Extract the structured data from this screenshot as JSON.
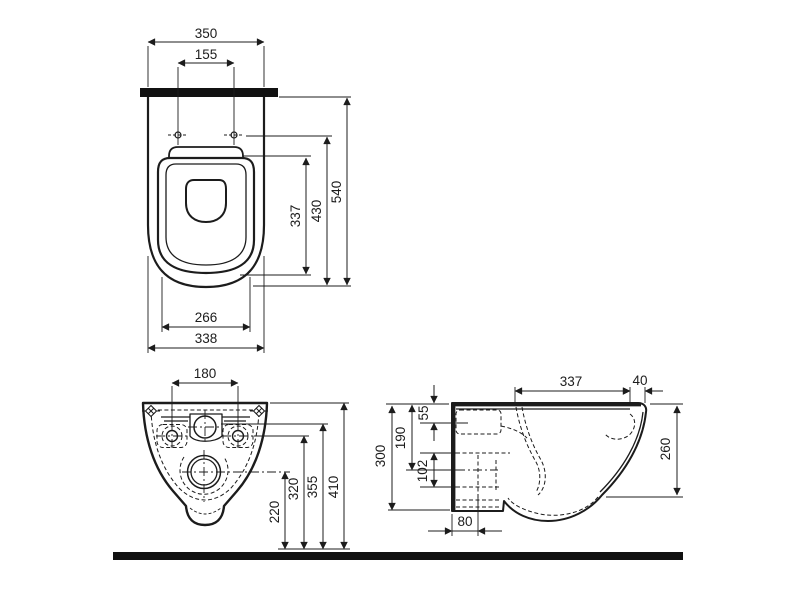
{
  "page": {
    "background": "#ffffff",
    "line_color": "#1c1c1c",
    "drawing_type": "wall-hung toilet installation dimensions, three orthographic views"
  },
  "views": {
    "top": {
      "dims": {
        "width": "350",
        "bolt_spacing": "155",
        "seat_depth": "337",
        "depth_inner": "430",
        "depth_total": "540",
        "seat_width": "266",
        "body_width": "338"
      }
    },
    "front": {
      "dims": {
        "fixing_spacing": "180",
        "drain_height": "220",
        "fixing_height": "320",
        "inlet_height": "355",
        "total_height": "410"
      }
    },
    "side": {
      "dims": {
        "depth_top": "337",
        "wall_gap": "40",
        "inlet_drop": "55",
        "outlet_drop": "190",
        "outlet_diameter": "102",
        "front_height": "260",
        "projection": "300",
        "outlet_offset": "80"
      }
    }
  }
}
